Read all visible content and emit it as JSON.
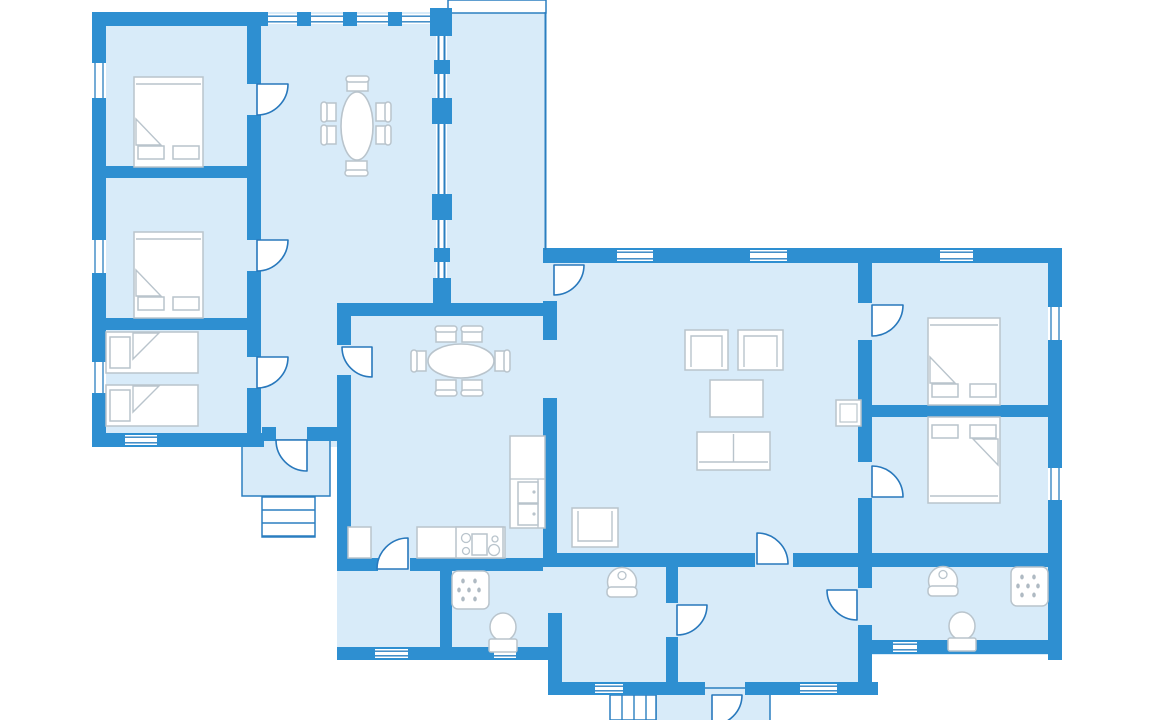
{
  "meta": {
    "kind": "floor-plan",
    "description": "cottage floor plan, no visible text"
  },
  "palette": {
    "wall": "#2E8FD1",
    "floor": "#D8EBF9",
    "line": "#2878BC",
    "thin": "#2B7FC0",
    "furn": "#B9C4CC",
    "drop": "#AFBAC3",
    "white": "#FFFFFF"
  },
  "canvas": {
    "w": 1152,
    "h": 720
  },
  "floors": [
    {
      "name": "left-wing-floor",
      "x": 95,
      "y": 12,
      "w": 355,
      "h": 435
    },
    {
      "name": "sunroom-floor",
      "x": 448,
      "y": 12,
      "w": 98,
      "h": 238
    },
    {
      "name": "main-floor",
      "x": 337,
      "y": 248,
      "w": 725,
      "h": 324
    },
    {
      "name": "south-left-floor",
      "x": 337,
      "y": 555,
      "w": 225,
      "h": 105
    },
    {
      "name": "south-center-floor",
      "x": 562,
      "y": 555,
      "w": 310,
      "h": 140
    },
    {
      "name": "south-right-floor",
      "x": 870,
      "y": 555,
      "w": 192,
      "h": 100
    }
  ],
  "porches": [
    {
      "name": "front-porch",
      "x": 242,
      "y": 440,
      "w": 88,
      "h": 56
    },
    {
      "name": "back-porch",
      "x": 656,
      "y": 688,
      "w": 114,
      "h": 34
    }
  ],
  "white_shapes": [
    {
      "name": "terrace-step",
      "x": 448,
      "y": 0,
      "w": 98,
      "h": 13
    }
  ],
  "stairs": [
    {
      "name": "front-steps",
      "x": 262,
      "y": 497,
      "w": 53,
      "h": 40,
      "dir": "h",
      "lines": [
        510,
        523,
        536
      ]
    },
    {
      "name": "back-steps",
      "x": 610,
      "y": 695,
      "w": 46,
      "h": 25,
      "dir": "v",
      "lines": [
        622,
        634,
        646
      ]
    }
  ],
  "walls": [
    {
      "name": "north-wall-west",
      "x": 92,
      "y": 12,
      "w": 176,
      "h": 14
    },
    {
      "name": "north-wall-pier",
      "x": 297,
      "y": 12,
      "w": 14,
      "h": 14
    },
    {
      "name": "north-wall-pier",
      "x": 343,
      "y": 12,
      "w": 14,
      "h": 14
    },
    {
      "name": "north-wall-pier",
      "x": 388,
      "y": 12,
      "w": 14,
      "h": 14
    },
    {
      "name": "west-wall",
      "x": 92,
      "y": 12,
      "w": 14,
      "h": 435
    },
    {
      "name": "west-wing-south-wall",
      "x": 92,
      "y": 433,
      "w": 172,
      "h": 14
    },
    {
      "name": "hall-south-wall",
      "x": 262,
      "y": 427,
      "w": 14,
      "h": 14
    },
    {
      "name": "hall-south-wall",
      "x": 307,
      "y": 427,
      "w": 31,
      "h": 14
    },
    {
      "name": "wing-corridor-wall",
      "x": 247,
      "y": 26,
      "w": 14,
      "h": 58
    },
    {
      "name": "wing-corridor-wall",
      "x": 247,
      "y": 115,
      "w": 14,
      "h": 125
    },
    {
      "name": "wing-corridor-wall",
      "x": 247,
      "y": 271,
      "w": 14,
      "h": 86
    },
    {
      "name": "wing-corridor-wall",
      "x": 247,
      "y": 388,
      "w": 14,
      "h": 45
    },
    {
      "name": "bedroom-divider",
      "x": 106,
      "y": 166,
      "w": 141,
      "h": 12
    },
    {
      "name": "bedroom-divider",
      "x": 106,
      "y": 318,
      "w": 141,
      "h": 12
    },
    {
      "name": "hall-bottom-wall",
      "x": 340,
      "y": 303,
      "w": 208,
      "h": 13
    },
    {
      "name": "kitchen-west-wall",
      "x": 337,
      "y": 303,
      "w": 14,
      "h": 42
    },
    {
      "name": "kitchen-west-wall",
      "x": 337,
      "y": 375,
      "w": 14,
      "h": 183
    },
    {
      "name": "kitchen-south-wall",
      "x": 337,
      "y": 558,
      "w": 41,
      "h": 13
    },
    {
      "name": "kitchen-south-wall",
      "x": 410,
      "y": 558,
      "w": 133,
      "h": 13
    },
    {
      "name": "main-north-wall",
      "x": 543,
      "y": 248,
      "w": 519,
      "h": 15
    },
    {
      "name": "east-wall",
      "x": 1048,
      "y": 248,
      "w": 14,
      "h": 412
    },
    {
      "name": "kitchen-living-wall",
      "x": 543,
      "y": 301,
      "w": 14,
      "h": 39
    },
    {
      "name": "kitchen-living-wall",
      "x": 543,
      "y": 398,
      "w": 14,
      "h": 169
    },
    {
      "name": "living-south-wall",
      "x": 543,
      "y": 553,
      "w": 212,
      "h": 14
    },
    {
      "name": "living-south-wall",
      "x": 793,
      "y": 553,
      "w": 269,
      "h": 14
    },
    {
      "name": "living-bedroom-wall",
      "x": 858,
      "y": 263,
      "w": 14,
      "h": 40
    },
    {
      "name": "living-bedroom-wall",
      "x": 858,
      "y": 340,
      "w": 14,
      "h": 122
    },
    {
      "name": "living-bedroom-wall",
      "x": 858,
      "y": 498,
      "w": 14,
      "h": 90
    },
    {
      "name": "living-bedroom-wall",
      "x": 858,
      "y": 625,
      "w": 14,
      "h": 70
    },
    {
      "name": "east-bedroom-divider",
      "x": 870,
      "y": 405,
      "w": 178,
      "h": 12
    },
    {
      "name": "bath1-west-wall",
      "x": 440,
      "y": 567,
      "w": 12,
      "h": 80
    },
    {
      "name": "bath1-east-wall",
      "x": 666,
      "y": 567,
      "w": 12,
      "h": 36
    },
    {
      "name": "bath1-east-wall",
      "x": 666,
      "y": 637,
      "w": 12,
      "h": 58
    },
    {
      "name": "bath1-step-wall",
      "x": 548,
      "y": 613,
      "w": 14,
      "h": 80
    },
    {
      "name": "south-left-wall",
      "x": 337,
      "y": 647,
      "w": 225,
      "h": 13
    },
    {
      "name": "south-center-wall",
      "x": 548,
      "y": 682,
      "w": 157,
      "h": 13
    },
    {
      "name": "south-center-wall",
      "x": 745,
      "y": 682,
      "w": 133,
      "h": 13
    },
    {
      "name": "south-right-wall",
      "x": 870,
      "y": 640,
      "w": 192,
      "h": 14
    }
  ],
  "posts": [
    {
      "name": "sunroom-post",
      "x": 430,
      "y": 8,
      "w": 22,
      "h": 28
    },
    {
      "name": "sunroom-post",
      "x": 434,
      "y": 60,
      "w": 16,
      "h": 14
    },
    {
      "name": "sunroom-post",
      "x": 432,
      "y": 98,
      "w": 20,
      "h": 26
    },
    {
      "name": "sunroom-post",
      "x": 432,
      "y": 194,
      "w": 20,
      "h": 26
    },
    {
      "name": "sunroom-post",
      "x": 434,
      "y": 248,
      "w": 16,
      "h": 14
    },
    {
      "name": "sunroom-post",
      "x": 433,
      "y": 278,
      "w": 18,
      "h": 25
    }
  ],
  "window_strip": {
    "name": "sunroom-glass-wall",
    "x": 436,
    "y": 12,
    "w": 11,
    "h": 290
  },
  "windows": [
    {
      "name": "window",
      "x": 268,
      "y": 14,
      "w": 29,
      "h": 10,
      "o": "h"
    },
    {
      "name": "window",
      "x": 311,
      "y": 14,
      "w": 32,
      "h": 10,
      "o": "h"
    },
    {
      "name": "window",
      "x": 357,
      "y": 14,
      "w": 31,
      "h": 10,
      "o": "h"
    },
    {
      "name": "window",
      "x": 402,
      "y": 14,
      "w": 28,
      "h": 10,
      "o": "h"
    },
    {
      "name": "window",
      "x": 92,
      "y": 63,
      "w": 14,
      "h": 35,
      "o": "v"
    },
    {
      "name": "window",
      "x": 92,
      "y": 240,
      "w": 14,
      "h": 33,
      "o": "v"
    },
    {
      "name": "window",
      "x": 92,
      "y": 362,
      "w": 14,
      "h": 31,
      "o": "v"
    },
    {
      "name": "window",
      "x": 125,
      "y": 435,
      "w": 32,
      "h": 10,
      "o": "h"
    },
    {
      "name": "window",
      "x": 617,
      "y": 250,
      "w": 36,
      "h": 11,
      "o": "h"
    },
    {
      "name": "window",
      "x": 750,
      "y": 250,
      "w": 37,
      "h": 11,
      "o": "h"
    },
    {
      "name": "window",
      "x": 940,
      "y": 250,
      "w": 33,
      "h": 11,
      "o": "h"
    },
    {
      "name": "window",
      "x": 1048,
      "y": 307,
      "w": 14,
      "h": 33,
      "o": "v"
    },
    {
      "name": "window",
      "x": 1048,
      "y": 468,
      "w": 14,
      "h": 32,
      "o": "v"
    },
    {
      "name": "window",
      "x": 375,
      "y": 649,
      "w": 33,
      "h": 9,
      "o": "h"
    },
    {
      "name": "window",
      "x": 494,
      "y": 649,
      "w": 22,
      "h": 9,
      "o": "h"
    },
    {
      "name": "window",
      "x": 595,
      "y": 684,
      "w": 28,
      "h": 9,
      "o": "h"
    },
    {
      "name": "window",
      "x": 800,
      "y": 684,
      "w": 37,
      "h": 9,
      "o": "h"
    },
    {
      "name": "window",
      "x": 893,
      "y": 642,
      "w": 24,
      "h": 10,
      "o": "h"
    }
  ],
  "lines": [
    {
      "name": "sunroom-glass-line",
      "x1": 438.5,
      "y1": 14,
      "x2": 438.5,
      "y2": 300
    },
    {
      "name": "sunroom-glass-line",
      "x1": 444.5,
      "y1": 14,
      "x2": 444.5,
      "y2": 300
    },
    {
      "name": "terrace-edge-line",
      "x1": 545.5,
      "y1": 12,
      "x2": 545.5,
      "y2": 250
    }
  ],
  "doors": [
    {
      "name": "bedroom1-door",
      "cx": 257,
      "cy": 84,
      "r": 31,
      "q": "ES"
    },
    {
      "name": "bedroom2-door",
      "cx": 257,
      "cy": 240,
      "r": 31,
      "q": "ES"
    },
    {
      "name": "twin-bedroom-door",
      "cx": 257,
      "cy": 357,
      "r": 31,
      "q": "ES"
    },
    {
      "name": "front-entrance-door",
      "cx": 307,
      "cy": 440,
      "r": 31,
      "q": "SW"
    },
    {
      "name": "dining-room-door",
      "cx": 372,
      "cy": 347,
      "r": 30,
      "q": "SW"
    },
    {
      "name": "utility-room-door",
      "cx": 408,
      "cy": 569,
      "r": 31,
      "q": "WN"
    },
    {
      "name": "sunroom-living-door",
      "cx": 554,
      "cy": 265,
      "r": 30,
      "q": "ES"
    },
    {
      "name": "living-hall-door",
      "cx": 757,
      "cy": 564,
      "r": 31,
      "q": "NE"
    },
    {
      "name": "bathroom1-door",
      "cx": 677,
      "cy": 605,
      "r": 30,
      "q": "ES"
    },
    {
      "name": "bathroom2-door",
      "cx": 857,
      "cy": 590,
      "r": 30,
      "q": "SW"
    },
    {
      "name": "east-bedroom1-door",
      "cx": 872,
      "cy": 305,
      "r": 31,
      "q": "ES"
    },
    {
      "name": "east-bedroom2-door",
      "cx": 872,
      "cy": 497,
      "r": 31,
      "q": "NE"
    },
    {
      "name": "back-entrance-door",
      "cx": 712,
      "cy": 695,
      "r": 30,
      "q": "ES"
    }
  ],
  "furniture": [
    {
      "t": "bed",
      "name": "double-bed-1",
      "x": 134,
      "y": 77,
      "w": 69,
      "h": 90,
      "head": "S"
    },
    {
      "t": "bed",
      "name": "double-bed-2",
      "x": 134,
      "y": 232,
      "w": 69,
      "h": 86,
      "head": "S"
    },
    {
      "t": "bed",
      "name": "double-bed-3",
      "x": 928,
      "y": 318,
      "w": 72,
      "h": 87,
      "head": "S"
    },
    {
      "t": "bed",
      "name": "double-bed-4",
      "x": 928,
      "y": 417,
      "w": 72,
      "h": 86,
      "head": "N"
    },
    {
      "t": "single",
      "name": "single-bed-1",
      "x": 106,
      "y": 332,
      "w": 92,
      "h": 41
    },
    {
      "t": "single",
      "name": "single-bed-2",
      "x": 106,
      "y": 385,
      "w": 92,
      "h": 41
    },
    {
      "t": "oval",
      "name": "hall-dining-table",
      "cx": 357,
      "cy": 126,
      "rx": 16,
      "ry": 34
    },
    {
      "t": "oval",
      "name": "dining-table",
      "cx": 461,
      "cy": 361,
      "rx": 33,
      "ry": 17
    },
    {
      "t": "chair",
      "name": "chair",
      "x": 347,
      "y": 76,
      "w": 21,
      "h": 15,
      "back": "N"
    },
    {
      "t": "chair",
      "name": "chair",
      "x": 346,
      "y": 161,
      "w": 21,
      "h": 15,
      "back": "S"
    },
    {
      "t": "chair",
      "name": "chair",
      "x": 321,
      "y": 103,
      "w": 15,
      "h": 18,
      "back": "W"
    },
    {
      "t": "chair",
      "name": "chair",
      "x": 321,
      "y": 126,
      "w": 15,
      "h": 18,
      "back": "W"
    },
    {
      "t": "chair",
      "name": "chair",
      "x": 376,
      "y": 103,
      "w": 15,
      "h": 18,
      "back": "E"
    },
    {
      "t": "chair",
      "name": "chair",
      "x": 376,
      "y": 126,
      "w": 15,
      "h": 18,
      "back": "E"
    },
    {
      "t": "chair",
      "name": "chair",
      "x": 436,
      "y": 326,
      "w": 20,
      "h": 16,
      "back": "N"
    },
    {
      "t": "chair",
      "name": "chair",
      "x": 462,
      "y": 326,
      "w": 20,
      "h": 16,
      "back": "N"
    },
    {
      "t": "chair",
      "name": "chair",
      "x": 436,
      "y": 380,
      "w": 20,
      "h": 16,
      "back": "S"
    },
    {
      "t": "chair",
      "name": "chair",
      "x": 462,
      "y": 380,
      "w": 20,
      "h": 16,
      "back": "S"
    },
    {
      "t": "chair",
      "name": "chair",
      "x": 411,
      "y": 351,
      "w": 15,
      "h": 20,
      "back": "W"
    },
    {
      "t": "chair",
      "name": "chair",
      "x": 495,
      "y": 351,
      "w": 15,
      "h": 20,
      "back": "E"
    },
    {
      "t": "armchair",
      "name": "armchair-1",
      "x": 685,
      "y": 330,
      "w": 43,
      "h": 40,
      "open": "S"
    },
    {
      "t": "armchair",
      "name": "armchair-2",
      "x": 738,
      "y": 330,
      "w": 45,
      "h": 40,
      "open": "S"
    },
    {
      "t": "armchair",
      "name": "armchair-3",
      "x": 572,
      "y": 508,
      "w": 46,
      "h": 39,
      "open": "N"
    },
    {
      "t": "rect",
      "name": "coffee-table",
      "x": 710,
      "y": 380,
      "w": 53,
      "h": 37
    },
    {
      "t": "sofa",
      "name": "sofa",
      "x": 697,
      "y": 432,
      "w": 73,
      "h": 38
    },
    {
      "t": "tv-bench",
      "name": "tv-bench",
      "x": 836,
      "y": 400,
      "w": 25,
      "h": 26
    },
    {
      "t": "rect",
      "name": "kitchen-cabinet",
      "x": 348,
      "y": 527,
      "w": 23,
      "h": 31
    },
    {
      "t": "rect",
      "name": "kitchen-counter",
      "x": 417,
      "y": 527,
      "w": 88,
      "h": 31
    },
    {
      "t": "stove",
      "name": "stove",
      "x": 456,
      "y": 527,
      "w": 47,
      "h": 31
    },
    {
      "t": "tall-unit",
      "name": "fridge-oven-unit",
      "x": 510,
      "y": 436,
      "w": 35,
      "h": 92
    },
    {
      "t": "shower",
      "name": "shower-1",
      "x": 452,
      "y": 571,
      "w": 37,
      "h": 38
    },
    {
      "t": "shower",
      "name": "shower-2",
      "x": 1011,
      "y": 567,
      "w": 37,
      "h": 39
    },
    {
      "t": "basin",
      "name": "washbasin-1",
      "cx": 622,
      "cy": 582
    },
    {
      "t": "basin",
      "name": "washbasin-2",
      "cx": 943,
      "cy": 581
    },
    {
      "t": "toilet",
      "name": "toilet-1",
      "cx": 503,
      "cy": 627
    },
    {
      "t": "toilet",
      "name": "toilet-2",
      "cx": 962,
      "cy": 626
    }
  ]
}
